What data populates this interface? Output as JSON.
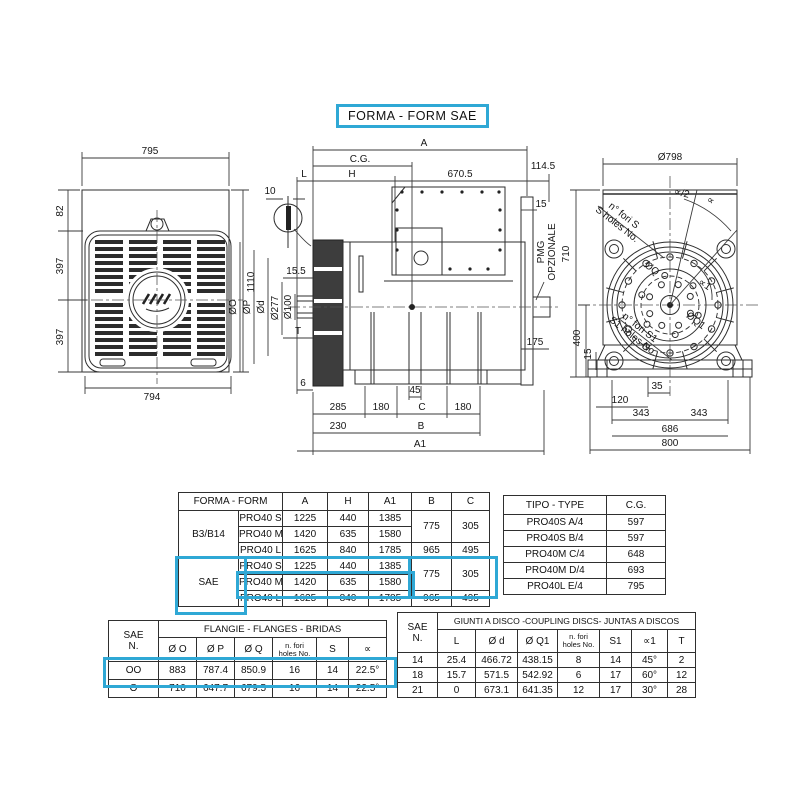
{
  "title": "FORMA - FORM  SAE",
  "colors": {
    "highlight": "#2fa8d5",
    "line": "#2e2e2e"
  },
  "front_view": {
    "w_top": "795",
    "w_bottom": "794",
    "h_total": "1110",
    "seg_a": "82",
    "seg_b": "397",
    "seg_c": "397"
  },
  "side_view": {
    "a": "A",
    "cg": "C.G.",
    "l": "L",
    "h": "H",
    "len670": "670.5",
    "len114": "114.5",
    "det10": "10",
    "t15": "15",
    "pmg1": "PMG",
    "pmg2": "OPZIONALE",
    "diaO": "ØO",
    "diaP": "ØP",
    "diaD": "Ød",
    "len155": "15.5",
    "dia277": "Ø277",
    "dia100": "Ø100",
    "t": "T",
    "len6": "6",
    "len45": "45",
    "len285": "285",
    "len180a": "180",
    "c": "C",
    "len180b": "180",
    "len230": "230",
    "b": "B",
    "a1": "A1",
    "len175": "175"
  },
  "rear_view": {
    "dia798": "Ø798",
    "foriS1": "n° fori S",
    "foriS2": "S holes No.",
    "alphaHalf": "∝/2",
    "alpha": "∝",
    "diaQ": "ØQ",
    "alpha1": "∝1",
    "diaQ1": "ØQ1",
    "foriS1a": "n° fori S1",
    "foriS1b": "S1 holes No.",
    "h710": "710",
    "h400": "400",
    "h15": "15",
    "w35": "35",
    "w120": "120",
    "w343a": "343",
    "w343b": "343",
    "w686": "686",
    "w800": "800"
  },
  "form_table": {
    "header": {
      "name": "FORMA - FORM",
      "a": "A",
      "h": "H",
      "a1": "A1",
      "b": "B",
      "c": "C"
    },
    "sections": [
      {
        "name": "B3/B14",
        "rows": [
          [
            "PRO40 S",
            "1225",
            "440",
            "1385"
          ],
          [
            "PRO40 M",
            "1420",
            "635",
            "1580"
          ],
          [
            "PRO40 L",
            "1625",
            "840",
            "1785"
          ]
        ],
        "b_sm": "775",
        "c_sm": "305",
        "b_l": "965",
        "c_l": "495"
      },
      {
        "name": "SAE",
        "rows": [
          [
            "PRO40 S",
            "1225",
            "440",
            "1385"
          ],
          [
            "PRO40 M",
            "1420",
            "635",
            "1580"
          ],
          [
            "PRO40 L",
            "1625",
            "840",
            "1785"
          ]
        ],
        "b_sm": "775",
        "c_sm": "305",
        "b_l": "965",
        "c_l": "495"
      }
    ]
  },
  "type_table": {
    "h1": "TIPO - TYPE",
    "h2": "C.G.",
    "rows": [
      [
        "PRO40S A/4",
        "597"
      ],
      [
        "PRO40S B/4",
        "597"
      ],
      [
        "PRO40M C/4",
        "648"
      ],
      [
        "PRO40M D/4",
        "693"
      ],
      [
        "PRO40L E/4",
        "795"
      ]
    ]
  },
  "flange_table": {
    "corner1": "SAE",
    "corner2": "N.",
    "title": "FLANGIE  - FLANGES - BRIDAS",
    "hO": "Ø O",
    "hP": "Ø P",
    "hQ": "Ø Q",
    "fori1": "n. fori",
    "fori2": "holes No.",
    "hS": "S",
    "hA": "∝",
    "rows": [
      [
        "OO",
        "883",
        "787.4",
        "850.9",
        "16",
        "14",
        "22.5°"
      ],
      [
        "O",
        "710",
        "647.7",
        "679.5",
        "16",
        "14",
        "22.5°"
      ]
    ]
  },
  "coupling_table": {
    "corner1": "SAE",
    "corner2": "N.",
    "title": "GIUNTI A DISCO -COUPLING DISCS- JUNTAS A DISCOS",
    "hL": "L",
    "hD": "Ø d",
    "hQ1": "Ø Q1",
    "fori1": "n. fori",
    "fori2": "holes No.",
    "hS1": "S1",
    "hA1": "∝1",
    "hT": "T",
    "rows": [
      [
        "14",
        "25.4",
        "466.72",
        "438.15",
        "8",
        "14",
        "45°",
        "2"
      ],
      [
        "18",
        "15.7",
        "571.5",
        "542.92",
        "6",
        "17",
        "60°",
        "12"
      ],
      [
        "21",
        "0",
        "673.1",
        "641.35",
        "12",
        "17",
        "30°",
        "28"
      ]
    ]
  }
}
